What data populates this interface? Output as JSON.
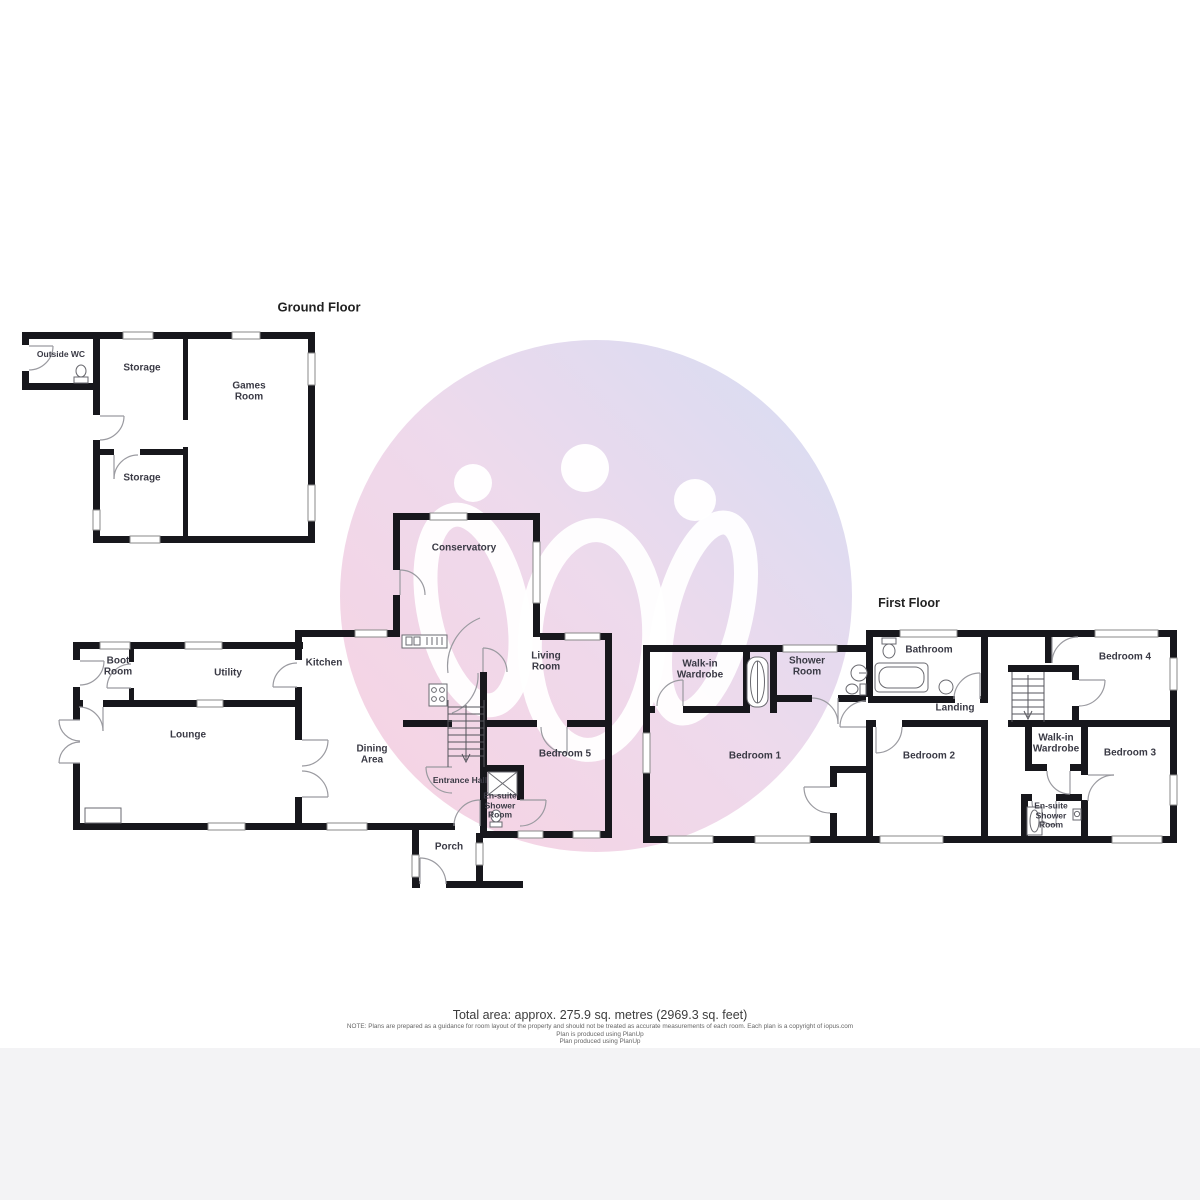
{
  "watermark": {
    "circle_colors": {
      "bottom_left": "#f5c7da",
      "middle": "#ead0e7",
      "top_right": "#cbd4f0"
    },
    "figure_color": "#ffffff"
  },
  "ground_floor": {
    "title": "Ground Floor",
    "outbuilding": {
      "outside_wc": "Outside WC",
      "storage_top": "Storage",
      "games_room": "Games Room",
      "storage_bottom": "Storage"
    },
    "main": {
      "boot_room": "Boot Room",
      "utility": "Utility",
      "lounge": "Lounge",
      "kitchen": "Kitchen",
      "dining_area": "Dining Area",
      "conservatory": "Conservatory",
      "living_room": "Living Room",
      "bedroom_5": "Bedroom 5",
      "entrance_hall": "Entrance Hall",
      "ensuite_shower_room": "En-suite Shower Room",
      "porch": "Porch"
    }
  },
  "first_floor": {
    "title": "First Floor",
    "rooms": {
      "walk_in_wardrobe_1": "Walk-in Wardrobe",
      "shower_room": "Shower Room",
      "bedroom_1": "Bedroom 1",
      "bathroom": "Bathroom",
      "landing": "Landing",
      "bedroom_4": "Bedroom 4",
      "bedroom_2": "Bedroom 2",
      "walk_in_wardrobe_2": "Walk-in Wardrobe",
      "bedroom_3": "Bedroom 3",
      "ensuite_shower_room": "En-suite Shower Room"
    }
  },
  "footer": {
    "total_area": "Total area: approx. 275.9 sq. metres (2969.3 sq. feet)",
    "note": "NOTE: Plans are prepared as a guidance for room layout of the property and should not be treated as accurate measurements of each room. Each plan is a copyright of iopus.com",
    "line2": "Plan is produced using PlanUp",
    "line3": "Plan produced using PlanUp"
  }
}
